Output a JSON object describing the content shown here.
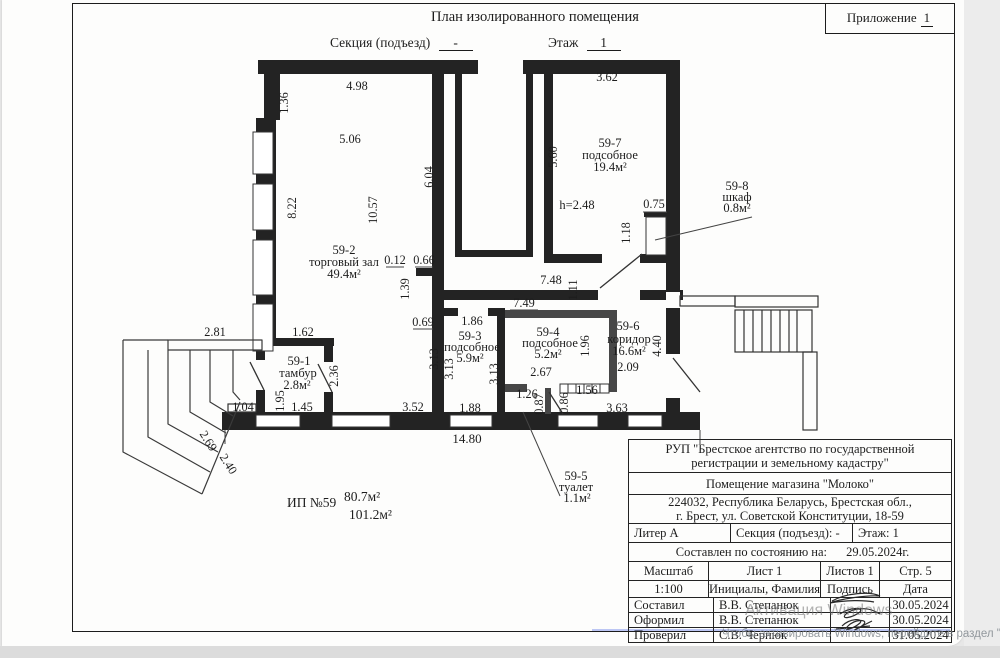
{
  "header": {
    "title": "План изолированного помещения",
    "annex_label": "Приложение",
    "annex_value": "1",
    "section_label": "Секция (подъезд)",
    "section_value": "-",
    "floor_label": "Этаж",
    "floor_value": "1"
  },
  "plan": {
    "rooms": {
      "r1": {
        "num": "59-1",
        "name": "тамбур",
        "area": "2.8м²"
      },
      "r2": {
        "num": "59-2",
        "name": "торговый зал",
        "area": "49.4м²"
      },
      "r3": {
        "num": "59-3",
        "name": "подсобное",
        "area": "5.9м²"
      },
      "r4": {
        "num": "59-4",
        "name": "подсобное",
        "area": "5.2м²"
      },
      "r5": {
        "num": "59-5",
        "name": "туалет",
        "area": "1.1м²"
      },
      "r6": {
        "num": "59-6",
        "name": "коридор",
        "area": "16.6м²"
      },
      "r7": {
        "num": "59-7",
        "name": "подсобное",
        "area": "19.4м²"
      },
      "r8": {
        "num": "59-8",
        "name": "шкаф",
        "area": "0.8м²"
      }
    },
    "height_note": "h=2.48",
    "dims": {
      "d498": "4.98",
      "d136": "1.36",
      "d506": "5.06",
      "d822": "8.22",
      "d1057": "10.57",
      "d604": "6.04",
      "d012": "0.12",
      "d066": "0.66",
      "d362": "3.62",
      "d560": "5.60",
      "d075": "0.75",
      "d118": "1.18",
      "d748": "7.48",
      "d111": "1.11",
      "d749": "7.49",
      "d139": "1.39",
      "d069": "0.69",
      "d186": "1.86",
      "d313": "3.13",
      "d196": "1.96",
      "d267": "2.67",
      "d209": "2.09",
      "d440": "4.40",
      "d281": "2.81",
      "d162": "1.62",
      "d236": "2.36",
      "d195": "1.95",
      "d104": "1.04",
      "d145": "1.45",
      "d352": "3.52",
      "d188": "1.88",
      "d126": "1.26",
      "d087": "0.87",
      "d086": "0.86",
      "d156": "1.56",
      "d363": "3.63",
      "d1480": "14.80",
      "d269": "2.69",
      "d240": "2.40"
    },
    "totals": {
      "unit": "ИП №59",
      "area_top": "80.7м²",
      "area_bottom": "101.2м²"
    }
  },
  "stamp": {
    "org_line1": "РУП \"Брестское агентство по государственной",
    "org_line2": "регистрации и земельному кадастру\"",
    "premises": "Помещение магазина \"Молоко\"",
    "address_line1": "224032, Республика Беларусь, Брестская обл.,",
    "address_line2": "г. Брест, ул. Советской Конституции, 18-59",
    "liter": "Литер А",
    "section": "Секция (подъезд): -",
    "floor": "Этаж: 1",
    "date_label": "Составлен по состоянию на:",
    "date_value": "29.05.2024г.",
    "scale_label": "Масштаб",
    "sheet": "Лист 1",
    "sheets": "Листов 1",
    "page": "Стр. 5",
    "scale_value": "1:100",
    "initials_header": "Инициалы, Фамилия",
    "sign_header": "Подпись",
    "date_header": "Дата",
    "rows": [
      {
        "role": "Составил",
        "name": "В.В. Степанюк",
        "date": "30.05.2024"
      },
      {
        "role": "Оформил",
        "name": "В.В. Степанюк",
        "date": "30.05.2024"
      },
      {
        "role": "Проверил",
        "name": "С.В. Чернюк",
        "date": "31.05.2024"
      }
    ]
  },
  "watermark": {
    "line1": "Активация Windows",
    "line2": "Чтобы активировать Windows, перейдите в раздел \"П"
  }
}
